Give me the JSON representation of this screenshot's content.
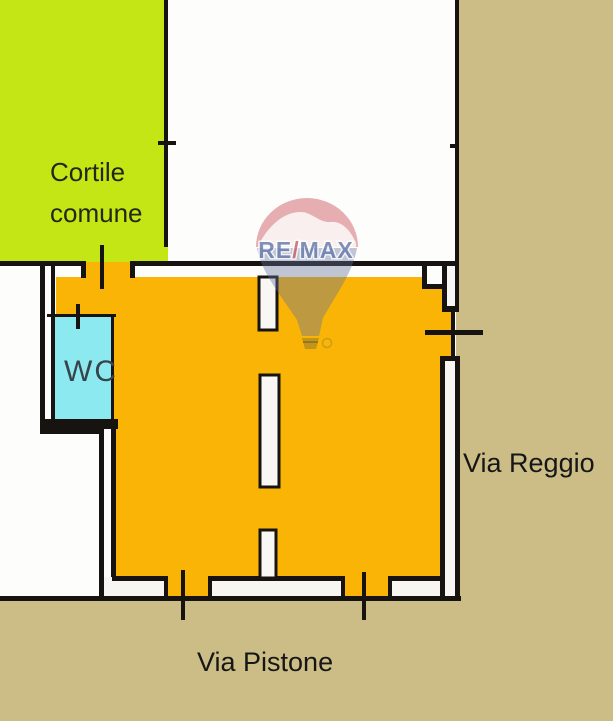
{
  "plan": {
    "labels": {
      "courtyard_line1": "Cortile",
      "courtyard_line2": "comune",
      "wc": "WC",
      "street_right": "Via Reggio",
      "street_bottom": "Via Pistone"
    },
    "watermark": {
      "brand_left": "RE",
      "brand_slash": "/",
      "brand_right": "MAX"
    },
    "colors": {
      "courtyard_green": "#c3e614",
      "unit_orange": "#f9b405",
      "wc_cyan": "#8ce9f0",
      "street_tan": "#cbbd85",
      "wall_black": "#171310",
      "label_text": "#161616",
      "courtyard_text": "#242718",
      "wc_text": "#37444a",
      "watermark_blue": "#6479ab",
      "watermark_red": "#c85f66",
      "balloon_red": "#d56d75",
      "balloon_lower": "#64719b"
    }
  }
}
